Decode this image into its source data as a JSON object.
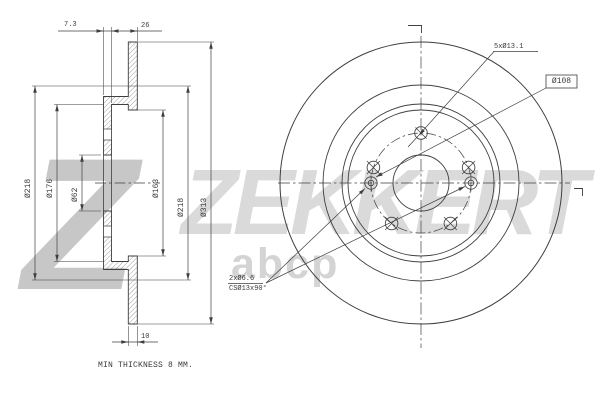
{
  "drawing": {
    "type": "brake-disc technical drawing",
    "views": [
      "cross-section",
      "front"
    ]
  },
  "section_view": {
    "dim_hat_thickness": "7.3",
    "dim_overall_height": "26",
    "dim_disc_thickness": "10",
    "note": "MIN THICKNESS 8 MM.",
    "diameters": [
      {
        "label": "Ø218"
      },
      {
        "label": "Ø176"
      },
      {
        "label": "Ø62"
      },
      {
        "label": "Ø163"
      },
      {
        "label": "Ø218"
      },
      {
        "label": "Ø313"
      }
    ]
  },
  "front_view": {
    "bolt_holes": "5xØ13.1",
    "bolt_circle": "Ø108",
    "set_screw_holes": "2xØ6.6",
    "countersink": "CSØ13x90°"
  },
  "watermark": {
    "logo_letter": "Z",
    "brand": "ZEKKERT",
    "distributor": "abcp"
  },
  "colors": {
    "line": "#3f3f3f",
    "watermark_logo": "#c7c7c7",
    "watermark_brand": "#dadada"
  }
}
